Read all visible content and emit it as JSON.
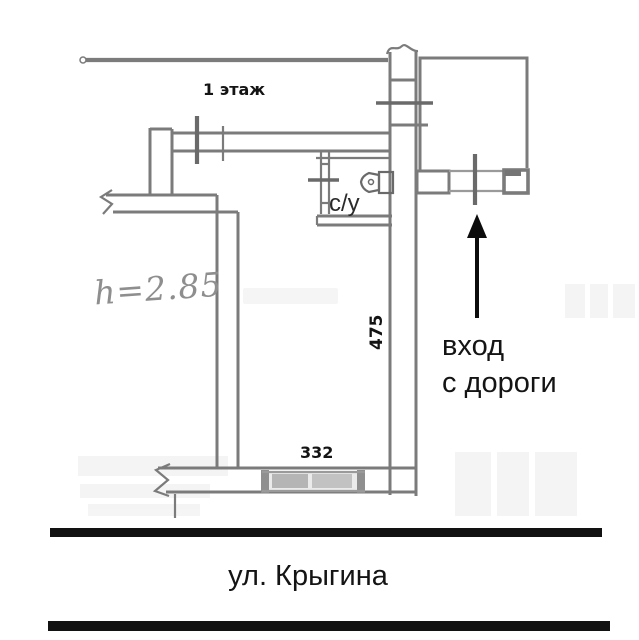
{
  "plan": {
    "floor_label": "1 этаж",
    "ceiling_height_label": "h=2.85",
    "bathroom_label": "с/у",
    "dimension_right_wall": "475",
    "dimension_bottom_window": "332",
    "entrance_note": {
      "line1": "вход",
      "line2": "с дороги"
    },
    "street_name": "ул. Крыгина"
  },
  "colors": {
    "wall_line": "#7b7b7b",
    "ink": "#141414",
    "pencil": "#8e8e8e",
    "street_line": "#121212",
    "watermark": "#ececec"
  }
}
